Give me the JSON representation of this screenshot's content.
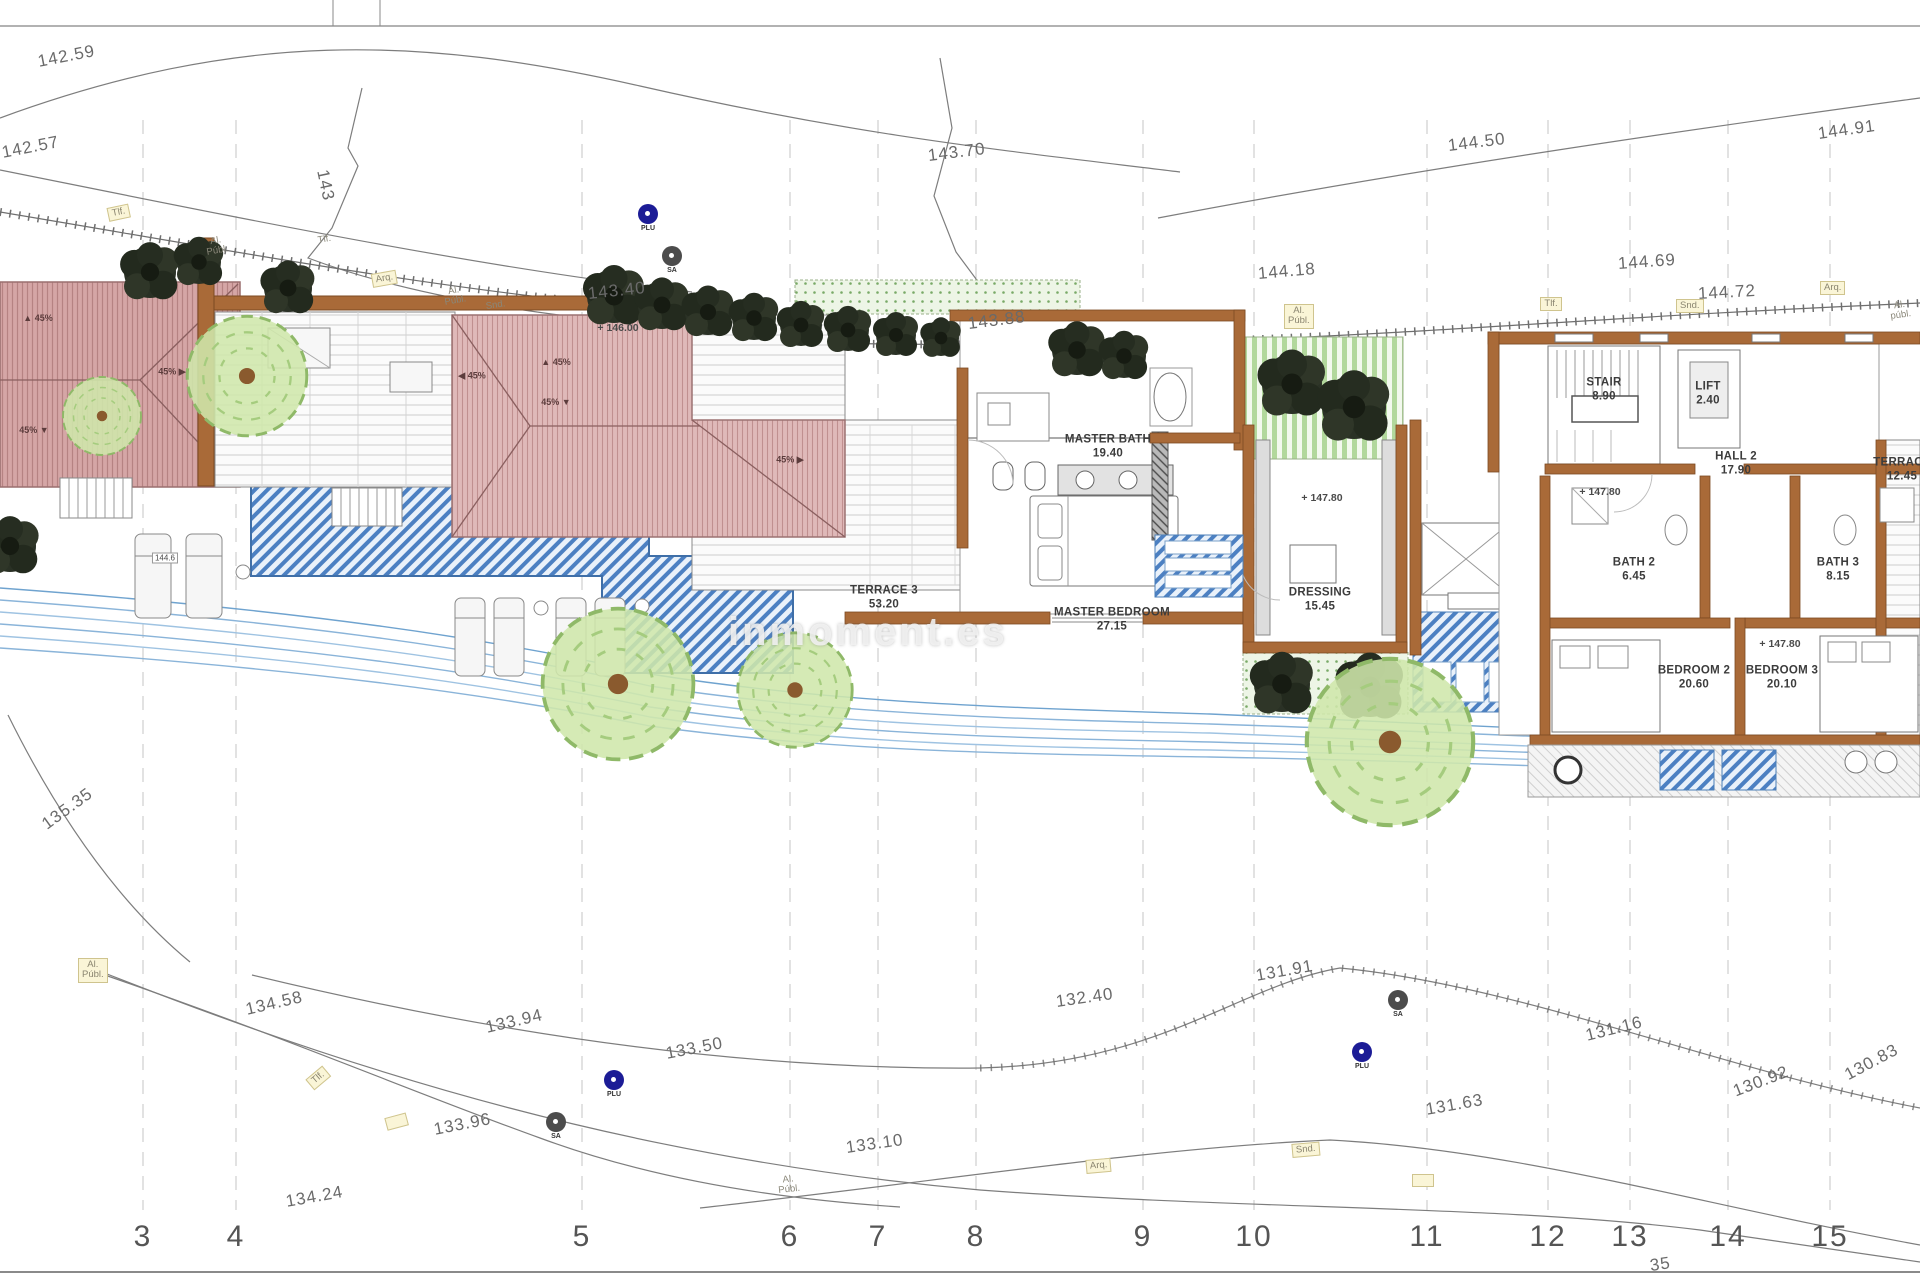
{
  "page": {
    "watermark": "inmoment.es"
  },
  "rooms": [
    {
      "name": "MASTER BATH",
      "area": "19.40",
      "x": 1108,
      "y": 447
    },
    {
      "name": "MASTER BEDROOM",
      "area": "27.15",
      "x": 1112,
      "y": 620
    },
    {
      "name": "TERRACE 3",
      "area": "53.20",
      "x": 884,
      "y": 598
    },
    {
      "name": "DRESSING",
      "area": "15.45",
      "x": 1320,
      "y": 600
    },
    {
      "name": "STAIR",
      "area": "8.90",
      "x": 1604,
      "y": 390
    },
    {
      "name": "LIFT",
      "area": "2.40",
      "x": 1708,
      "y": 394
    },
    {
      "name": "HALL 2",
      "area": "17.90",
      "x": 1736,
      "y": 464
    },
    {
      "name": "BATH 2",
      "area": "6.45",
      "x": 1634,
      "y": 570
    },
    {
      "name": "BATH 3",
      "area": "8.15",
      "x": 1838,
      "y": 570
    },
    {
      "name": "BEDROOM 2",
      "area": "20.60",
      "x": 1694,
      "y": 678
    },
    {
      "name": "BEDROOM 3",
      "area": "20.10",
      "x": 1782,
      "y": 678
    },
    {
      "name": "TERRACE",
      "area": "12.45",
      "x": 1902,
      "y": 470
    }
  ],
  "levels": [
    {
      "text": "+ 146.00",
      "x": 618,
      "y": 328
    },
    {
      "text": "+ 147.80",
      "x": 1322,
      "y": 498
    },
    {
      "text": "+ 147.80",
      "x": 1600,
      "y": 492
    },
    {
      "text": "+ 147.80",
      "x": 1780,
      "y": 644
    },
    {
      "text": "144.6",
      "x": 165,
      "y": 558,
      "boxed": true
    }
  ],
  "contours": [
    {
      "text": "142.59",
      "x": 38,
      "y": 52,
      "rot": -11
    },
    {
      "text": "142.57",
      "x": 2,
      "y": 143,
      "rot": -11
    },
    {
      "text": "143",
      "x": 322,
      "y": 160,
      "rot": 78
    },
    {
      "text": "143.70",
      "x": 928,
      "y": 146,
      "rot": -7
    },
    {
      "text": "144.50",
      "x": 1448,
      "y": 136,
      "rot": -7
    },
    {
      "text": "144.91",
      "x": 1818,
      "y": 124,
      "rot": -8
    },
    {
      "text": "143.40",
      "x": 588,
      "y": 284,
      "rot": -6
    },
    {
      "text": "144.18",
      "x": 1258,
      "y": 264,
      "rot": -5
    },
    {
      "text": "144.69",
      "x": 1618,
      "y": 254,
      "rot": -4
    },
    {
      "text": "144.72",
      "x": 1698,
      "y": 284,
      "rot": -3
    },
    {
      "text": "143.88",
      "x": 968,
      "y": 314,
      "rot": -7
    },
    {
      "text": "135.35",
      "x": 44,
      "y": 816,
      "rot": -36
    },
    {
      "text": "134.58",
      "x": 246,
      "y": 1000,
      "rot": -13
    },
    {
      "text": "133.94",
      "x": 486,
      "y": 1018,
      "rot": -13
    },
    {
      "text": "133.50",
      "x": 666,
      "y": 1044,
      "rot": -11
    },
    {
      "text": "133.96",
      "x": 434,
      "y": 1120,
      "rot": -11
    },
    {
      "text": "134.24",
      "x": 286,
      "y": 1192,
      "rot": -10
    },
    {
      "text": "133.10",
      "x": 846,
      "y": 1138,
      "rot": -8
    },
    {
      "text": "132.40",
      "x": 1056,
      "y": 992,
      "rot": -8
    },
    {
      "text": "131.91",
      "x": 1256,
      "y": 966,
      "rot": -10
    },
    {
      "text": "131.63",
      "x": 1426,
      "y": 1100,
      "rot": -10
    },
    {
      "text": "131.16",
      "x": 1586,
      "y": 1026,
      "rot": -14
    },
    {
      "text": "130.92",
      "x": 1734,
      "y": 1082,
      "rot": -21
    },
    {
      "text": "130.83",
      "x": 1846,
      "y": 1066,
      "rot": -28
    },
    {
      "text": "35",
      "x": 1650,
      "y": 1256,
      "rot": -8
    }
  ],
  "utilities": [
    {
      "text": "Tlf.",
      "x": 108,
      "y": 208,
      "rot": -12,
      "boxed": true
    },
    {
      "text": "Al.\nPúbl.",
      "x": 206,
      "y": 238,
      "rot": -10
    },
    {
      "text": "Tlf.",
      "x": 318,
      "y": 236,
      "rot": -10
    },
    {
      "text": "Arq.",
      "x": 372,
      "y": 274,
      "rot": -10,
      "boxed": true
    },
    {
      "text": "Al.\nPúbl.",
      "x": 444,
      "y": 288,
      "rot": -10
    },
    {
      "text": "Snd.",
      "x": 486,
      "y": 302,
      "rot": -8
    },
    {
      "text": "Al.\nPúbl.",
      "x": 1284,
      "y": 304,
      "rot": 0,
      "boxed": true
    },
    {
      "text": "Tlf.",
      "x": 1540,
      "y": 297,
      "rot": 0,
      "boxed": true
    },
    {
      "text": "Snd.",
      "x": 1676,
      "y": 299,
      "rot": 0,
      "boxed": true
    },
    {
      "text": "Arq.",
      "x": 1820,
      "y": 281,
      "rot": 0,
      "boxed": true
    },
    {
      "text": "Al.\npúbl.",
      "x": 1890,
      "y": 302,
      "rot": -8
    },
    {
      "text": "Al.\nPúbl.",
      "x": 78,
      "y": 958,
      "rot": 0,
      "boxed": true
    },
    {
      "text": "Tlf.",
      "x": 310,
      "y": 1078,
      "rot": -40,
      "boxed": true
    },
    {
      "text": "",
      "x": 386,
      "y": 1118,
      "rot": -15,
      "boxed": true
    },
    {
      "text": "Al.\nPúbl.",
      "x": 778,
      "y": 1176,
      "rot": -6
    },
    {
      "text": "Arq.",
      "x": 1086,
      "y": 1160,
      "rot": -5,
      "boxed": true
    },
    {
      "text": "Snd.",
      "x": 1292,
      "y": 1144,
      "rot": -5,
      "boxed": true
    },
    {
      "text": "",
      "x": 1412,
      "y": 1174,
      "rot": 0,
      "boxed": true
    }
  ],
  "markers": [
    {
      "type": "PLU",
      "x": 648,
      "y": 218
    },
    {
      "type": "SA",
      "x": 672,
      "y": 260
    },
    {
      "type": "PLU",
      "x": 614,
      "y": 1084
    },
    {
      "type": "SA",
      "x": 556,
      "y": 1126
    },
    {
      "type": "SA",
      "x": 1398,
      "y": 1004
    },
    {
      "type": "PLU",
      "x": 1362,
      "y": 1056
    }
  ],
  "roof_labels": [
    {
      "text": "▲ 45%",
      "x": 38,
      "y": 318
    },
    {
      "text": "45% ▼",
      "x": 34,
      "y": 430
    },
    {
      "text": "45% ▶",
      "x": 172,
      "y": 372
    },
    {
      "text": "◀ 45%",
      "x": 472,
      "y": 376
    },
    {
      "text": "▲ 45%",
      "x": 556,
      "y": 362
    },
    {
      "text": "45% ▼",
      "x": 556,
      "y": 402
    },
    {
      "text": "45% ▶",
      "x": 790,
      "y": 460
    }
  ],
  "grid": [
    {
      "text": "3",
      "x": 143,
      "y": 1237
    },
    {
      "text": "4",
      "x": 236,
      "y": 1237
    },
    {
      "text": "5",
      "x": 582,
      "y": 1237
    },
    {
      "text": "6",
      "x": 790,
      "y": 1237
    },
    {
      "text": "7",
      "x": 878,
      "y": 1237
    },
    {
      "text": "8",
      "x": 976,
      "y": 1237
    },
    {
      "text": "9",
      "x": 1143,
      "y": 1237
    },
    {
      "text": "10",
      "x": 1254,
      "y": 1237
    },
    {
      "text": "11",
      "x": 1427,
      "y": 1237
    },
    {
      "text": "12",
      "x": 1548,
      "y": 1237
    },
    {
      "text": "13",
      "x": 1630,
      "y": 1237
    },
    {
      "text": "14",
      "x": 1728,
      "y": 1237
    },
    {
      "text": "15",
      "x": 1830,
      "y": 1237
    }
  ],
  "colors": {
    "roof_pink": "#dfb9b9",
    "roof_garage": "#d5a6a6",
    "pool_blue": "#4c80c2",
    "stream_blue": "#8ab4d9",
    "garden_green": "#79aa67",
    "wall_brown": "#a96a38",
    "marker_plu": "#1c1c96",
    "marker_sa": "#4c4c4c",
    "util_box": "#faf5d7"
  }
}
